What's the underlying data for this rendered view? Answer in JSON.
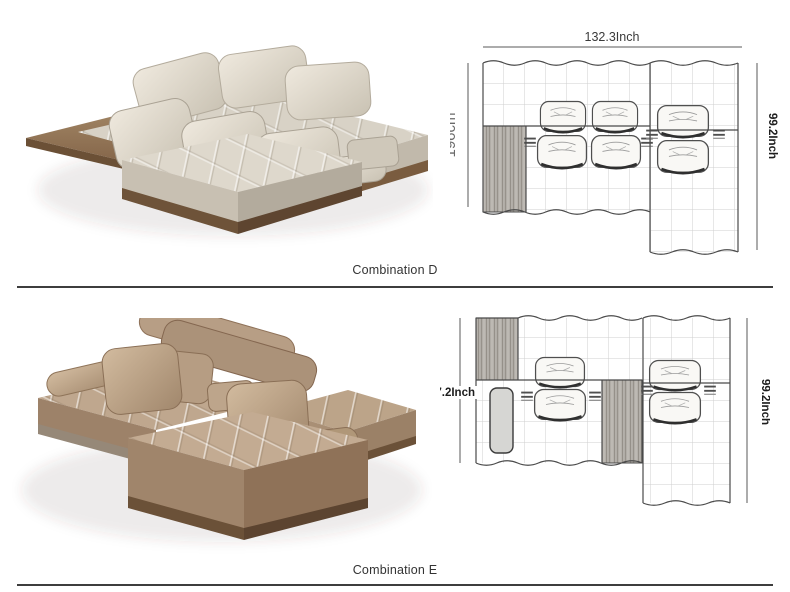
{
  "combinations": [
    {
      "caption": "Combination D",
      "top_dim": "132.3Inch",
      "left_dim": "196cm",
      "right_dim": "99.2Inch"
    },
    {
      "caption": "Combination E",
      "top_dim": "132.3Inch",
      "left_dim": "77.2Inch",
      "right_dim": "99.2Inch"
    }
  ],
  "colors": {
    "outline": "#4a4a4a",
    "grid": "#cfcfcf",
    "dim_text": "#3a3a3a",
    "dim_text_secondary": "#6a6a6a",
    "separator": "#3d3d3d",
    "sofa_d_leather": "#d8d2c6",
    "sofa_e_leather": "#bfa78e",
    "wood_base": "#8a6c4e",
    "diagram_wood_fill": "#b4b0aa"
  }
}
